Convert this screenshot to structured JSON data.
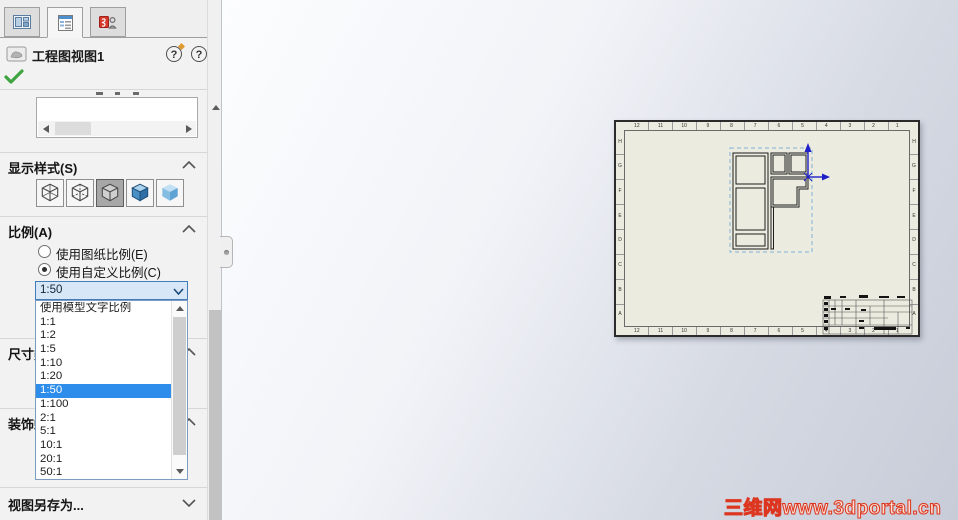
{
  "header": {
    "title": "工程图视图1",
    "help_glyph": "?"
  },
  "display_style": {
    "label": "显示样式(S)",
    "buttons": [
      "wireframe",
      "hidden-lines-visible",
      "hidden-lines-removed",
      "shaded-with-edges",
      "shaded"
    ],
    "selected": "hidden-lines-removed"
  },
  "scale": {
    "label": "比例(A)",
    "use_sheet_scale": "使用图纸比例(E)",
    "use_custom_scale": "使用自定义比例(C)",
    "selected_radio": "custom",
    "combo_value": "1:50",
    "options": [
      {
        "label": "使用模型文字比例",
        "selected": false
      },
      {
        "label": "1:1",
        "selected": false
      },
      {
        "label": "1:2",
        "selected": false
      },
      {
        "label": "1:5",
        "selected": false
      },
      {
        "label": "1:10",
        "selected": false
      },
      {
        "label": "1:20",
        "selected": false
      },
      {
        "label": "1:50",
        "selected": true
      },
      {
        "label": "1:100",
        "selected": false
      },
      {
        "label": "2:1",
        "selected": false
      },
      {
        "label": "5:1",
        "selected": false
      },
      {
        "label": "10:1",
        "selected": false
      },
      {
        "label": "20:1",
        "selected": false
      },
      {
        "label": "50:1",
        "selected": false
      }
    ]
  },
  "partial_sections": {
    "dimension_type": "尺寸类型",
    "cosmetic_thread": "装饰螺纹线显示"
  },
  "save_view_as": {
    "label": "视图另存为..."
  },
  "sheet": {
    "zone_columns": [
      "12",
      "11",
      "10",
      "9",
      "8",
      "7",
      "6",
      "5",
      "4",
      "3",
      "2",
      "1"
    ],
    "zone_rows": [
      "H",
      "G",
      "F",
      "E",
      "D",
      "C",
      "B",
      "A"
    ]
  },
  "watermark": {
    "text": "三维网www.3dportal.cn",
    "color": "#e03022"
  }
}
